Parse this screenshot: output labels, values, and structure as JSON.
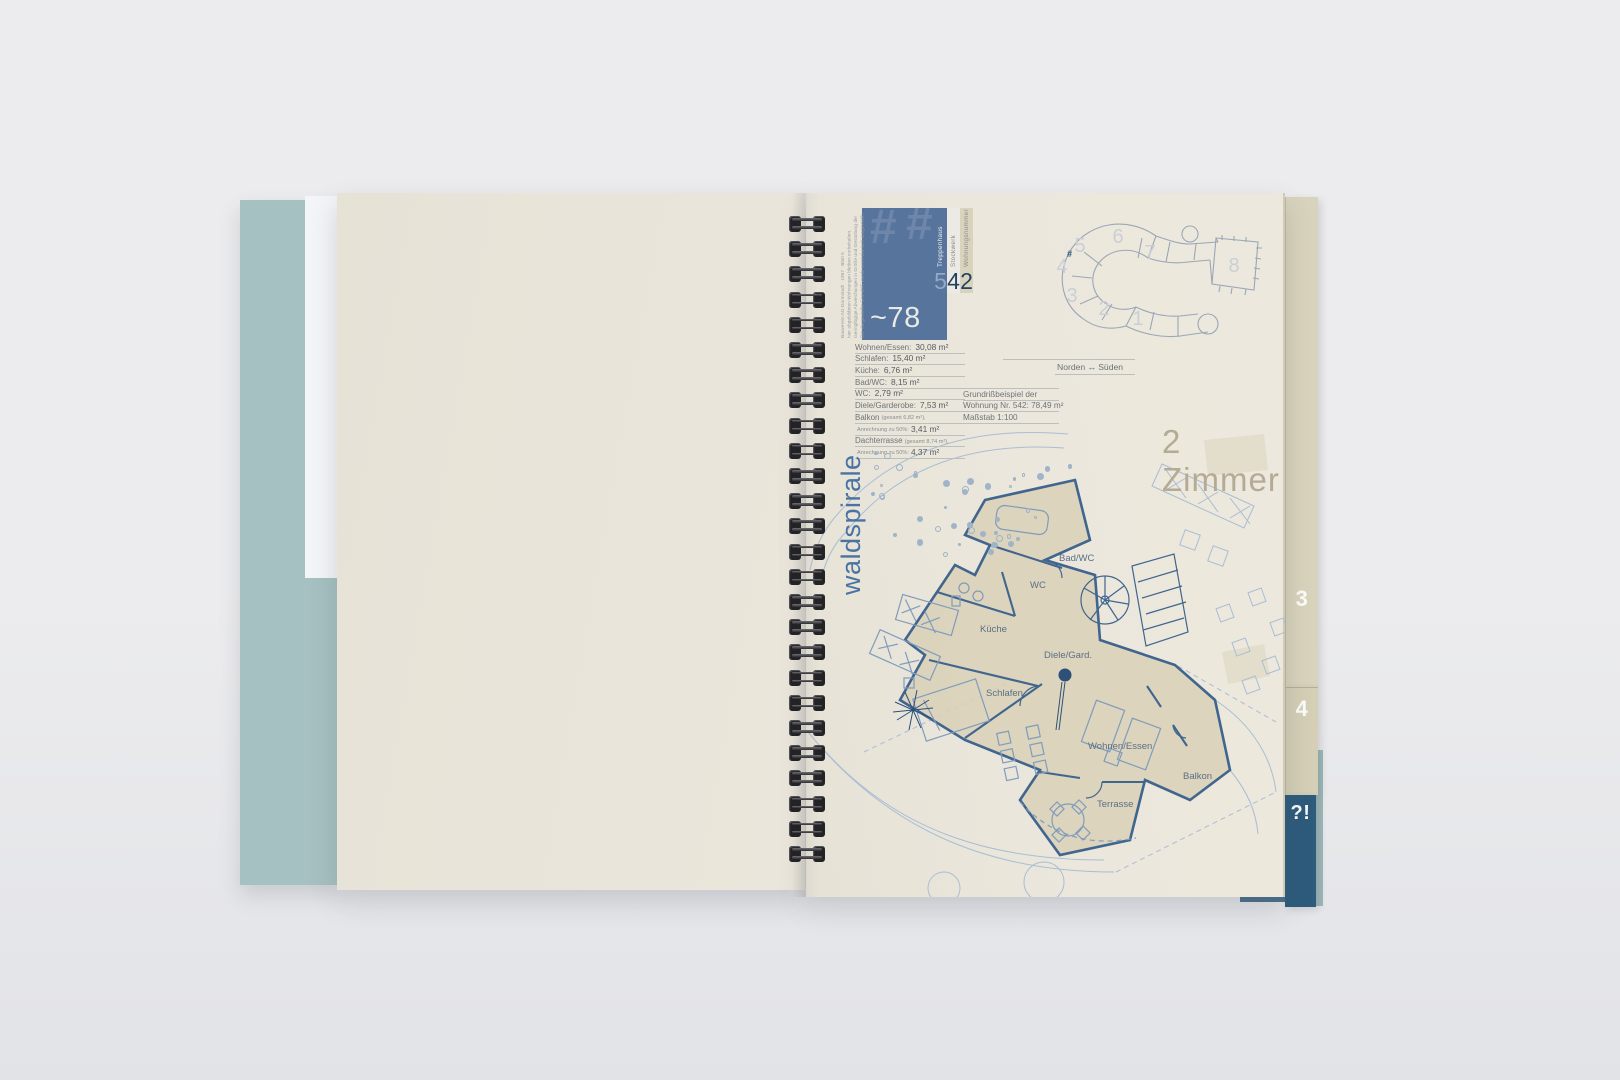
{
  "colors": {
    "bg-top": "#ececee",
    "bg-bottom": "#e2e3e7",
    "cover-teal": "#a6c1c1",
    "sheet-white": "#f3f5f7",
    "page-left": "#e8e4d9",
    "page-right": "#ebe7dc",
    "accent-blue": "#56749c",
    "dark-blue": "#24415d",
    "light-blue-num": "#93a9c6",
    "strip-white": "#eceae4",
    "strip-beige": "#d8d3bd",
    "text-gray": "#6d7176",
    "rule-gray": "#bcbfba",
    "brand-blue": "#4a72a3",
    "zimmer-beige": "#b5ab95",
    "plan-wall": "#40658e",
    "plan-light": "#a9bdd4",
    "plan-fill": "#d9d0b6",
    "site-line": "#9aa7b6",
    "site-num": "#caced6",
    "tab-beige": "#d8d3bc",
    "tab-beige2": "#d4cfb6",
    "tab-blue": "#2d5b7c",
    "binding-dark": "#232325"
  },
  "info_box": {
    "hash_glyphs": [
      "#",
      "#"
    ],
    "area_prefix": "~78 m",
    "area_sup": "2",
    "columns": [
      {
        "label": "Treppenhaus",
        "number": "5"
      },
      {
        "label": "Stockwerk",
        "number": "4"
      },
      {
        "label": "Wohnungsnummer",
        "number": "2"
      }
    ],
    "disclaimer_lines": [
      "Der dargestellte Grundriß wurde exemplarisch ausgewählt.",
      "Geringfügige Abweichungen in Größe und Gestaltung der",
      "hier abgebildeten Wohnungen bleiben vorbehalten.",
      "Bauverein AG Darmstadt · 1997 · Blatt 5"
    ]
  },
  "area_table": {
    "rows": [
      {
        "label": "Wohnen/Essen:",
        "note": "",
        "value": "30,08 m²"
      },
      {
        "label": "Schlafen:",
        "note": "",
        "value": "15,40 m²"
      },
      {
        "label": "Küche:",
        "note": "",
        "value": "6,76 m²"
      },
      {
        "label": "Bad/WC:",
        "note": "",
        "value": "8,15 m²"
      },
      {
        "label": "WC:",
        "note": "",
        "value": "2,79 m²"
      },
      {
        "label": "Diele/Garderobe:",
        "note": "",
        "value": "7,53 m²"
      },
      {
        "label": "Balkon",
        "note": "(gesamt 6,82 m²),",
        "value": ""
      },
      {
        "label": "",
        "note": "Anrechnung zu 50%:",
        "value": "3,41 m²"
      },
      {
        "label": "Dachterrasse",
        "note": "(gesamt 8,74 m²),",
        "value": ""
      },
      {
        "label": "",
        "note": "Anrechnung zu 50%:",
        "value": "4,37 m²"
      }
    ]
  },
  "example_info": {
    "line1": "Grundrißbeispiel der",
    "line2": "Wohnung Nr. 542: 78,49 m²",
    "line3": "Maßstab 1:100"
  },
  "compass": {
    "north": "Norden",
    "arrow": "↔",
    "south": "Süden"
  },
  "site_plan": {
    "numbers": [
      "1",
      "2",
      "3",
      "4",
      "5",
      "6",
      "7",
      "8"
    ],
    "marker": "#"
  },
  "brand": {
    "name": "waldspirale"
  },
  "plan": {
    "type_label": "2 Zimmer",
    "room_labels": [
      "Bad/WC",
      "WC",
      "Küche",
      "Diele/Gard.",
      "Schlafen",
      "Wohnen/Essen",
      "Balkon",
      "Terrasse"
    ]
  },
  "tabs": [
    {
      "label": "3"
    },
    {
      "label": "4"
    },
    {
      "label": "?!"
    }
  ]
}
